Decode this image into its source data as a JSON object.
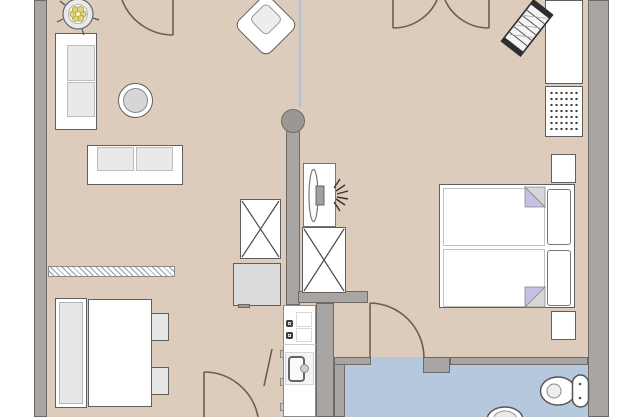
{
  "canvas": {
    "width": 640,
    "height": 417
  },
  "palette": {
    "background": "#ffffff",
    "floor": "#ddcbbc",
    "bathroom_floor": "#b5c8dd",
    "wall": "#a8a5a2",
    "wall_outline": "#6e6a66",
    "furniture_fill": "#ffffff",
    "furniture_outline": "#5f5f5f",
    "cushion": "#e9e9e9",
    "appliance": "#dcdcdc",
    "door_line": "#6f5d50",
    "blanket_fold": "#c6c1e0",
    "blanket_fold_gray": "#d7d7d7",
    "plant_foliage": "#ddd47b",
    "divider_line": "#a9c2d6",
    "column": "#9b9794"
  },
  "rooms": [
    {
      "id": "living-dining-area",
      "floor": "beige"
    },
    {
      "id": "kitchen",
      "floor": "beige"
    },
    {
      "id": "hallway",
      "floor": "beige"
    },
    {
      "id": "bedroom",
      "floor": "beige"
    },
    {
      "id": "bathroom",
      "floor": "blue"
    }
  ],
  "furniture": [
    {
      "id": "potted-plant",
      "room": "living-dining-area"
    },
    {
      "id": "sofa-left",
      "room": "living-dining-area"
    },
    {
      "id": "sofa-center",
      "room": "living-dining-area"
    },
    {
      "id": "armchair",
      "room": "living-dining-area"
    },
    {
      "id": "round-coffee-table",
      "room": "living-dining-area"
    },
    {
      "id": "hatched-sideboard",
      "room": "living-dining-area"
    },
    {
      "id": "bench",
      "room": "living-dining-area"
    },
    {
      "id": "dining-table",
      "room": "living-dining-area"
    },
    {
      "id": "chair-1",
      "room": "living-dining-area"
    },
    {
      "id": "chair-2",
      "room": "living-dining-area"
    },
    {
      "id": "fridge",
      "room": "kitchen"
    },
    {
      "id": "tall-cabinet-left",
      "room": "kitchen"
    },
    {
      "id": "tall-cabinet-right",
      "room": "hallway"
    },
    {
      "id": "tv-unit",
      "room": "hallway"
    },
    {
      "id": "kitchen-counter",
      "room": "kitchen"
    },
    {
      "id": "cooktop",
      "room": "kitchen"
    },
    {
      "id": "kitchen-sink",
      "room": "kitchen"
    },
    {
      "id": "oven",
      "room": "kitchen"
    },
    {
      "id": "double-bed",
      "room": "bedroom"
    },
    {
      "id": "pillow-1",
      "room": "bedroom"
    },
    {
      "id": "pillow-2",
      "room": "bedroom"
    },
    {
      "id": "nightstand-top",
      "room": "bedroom"
    },
    {
      "id": "nightstand-bottom",
      "room": "bedroom"
    },
    {
      "id": "wardrobe",
      "room": "bedroom"
    },
    {
      "id": "dotted-dresser",
      "room": "bedroom"
    },
    {
      "id": "crib-rack",
      "room": "bedroom"
    },
    {
      "id": "toilet",
      "room": "bathroom"
    },
    {
      "id": "washbasin",
      "room": "bathroom"
    }
  ],
  "architecture": [
    {
      "id": "round-column"
    },
    {
      "id": "room-divider-line"
    },
    {
      "id": "door-top-left"
    },
    {
      "id": "double-door-top"
    },
    {
      "id": "door-bottom"
    },
    {
      "id": "door-bathroom"
    },
    {
      "id": "door-leaf-kitchen"
    }
  ]
}
